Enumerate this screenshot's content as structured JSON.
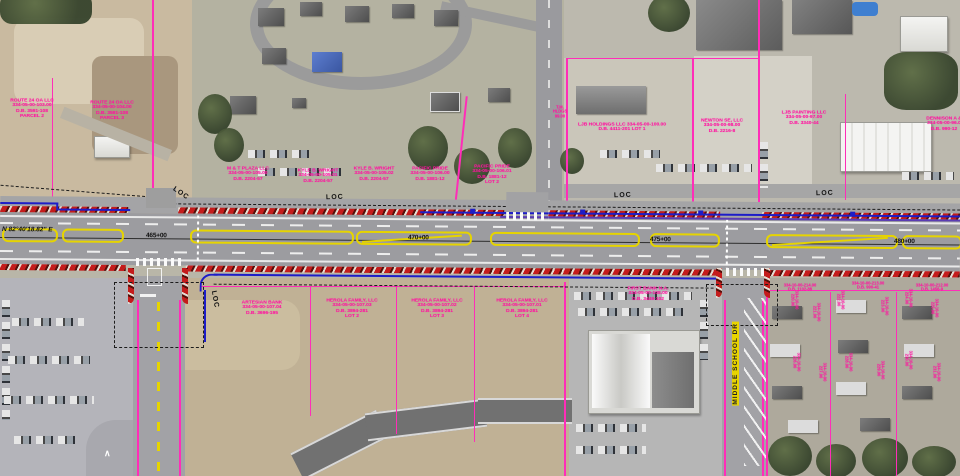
{
  "road": {
    "bearing": "N 82°40'18.82\" E",
    "stations": [
      "465+00",
      "470+00",
      "475+00",
      "480+00"
    ],
    "loc_label": "LOC",
    "street_name_vertical": "MIDDLE SCHOOL DR"
  },
  "annotations": [
    {
      "x": 32,
      "y": 98,
      "rot": 0,
      "lines": [
        "ROUTE 24 OA LLC",
        "334-05-00-103.00",
        "D.B. 3591-108",
        "PARCEL 2"
      ]
    },
    {
      "x": 112,
      "y": 100,
      "rot": 0,
      "lines": [
        "ROUTE 24 OA LLC",
        "334-05-00-104.00",
        "D.B. 3591-108",
        "PARCEL 3"
      ]
    },
    {
      "x": 248,
      "y": 166,
      "rot": 0,
      "lines": [
        "M & T PLAZA LLC",
        "334-05-00-105.00",
        "D.B. 2204-57"
      ]
    },
    {
      "x": 318,
      "y": 168,
      "rot": 0,
      "lines": [
        "KYLE B. WRIGHT",
        "334-05-00-105.01",
        "D.B. 2204-57"
      ]
    },
    {
      "x": 374,
      "y": 166,
      "rot": 0,
      "lines": [
        "KYLE B. WRIGHT",
        "334-05-00-105.02",
        "D.B. 2204-57"
      ]
    },
    {
      "x": 430,
      "y": 166,
      "rot": 0,
      "lines": [
        "PACIFIC PRIDE",
        "334-05-00-106.00",
        "D.B. 1881-12"
      ]
    },
    {
      "x": 492,
      "y": 164,
      "rot": 0,
      "lines": [
        "PACIFIC PRIDE",
        "334-05-00-106.01",
        "D.B. 1881-12",
        "LOT 2"
      ]
    },
    {
      "x": 560,
      "y": 106,
      "rot": 0,
      "lines": [
        "T.M.",
        "HLDGS",
        "99.00"
      ],
      "small": true
    },
    {
      "x": 622,
      "y": 122,
      "rot": 0,
      "lines": [
        "LJB HOLDINGS LLC  334-05-00-100.00",
        "D.B. 4411-201  LOT 1"
      ]
    },
    {
      "x": 722,
      "y": 118,
      "rot": 0,
      "lines": [
        "NEWTON SE, LLC",
        "334-05-00-98.00",
        "D.B. 2216-8"
      ]
    },
    {
      "x": 804,
      "y": 110,
      "rot": 0,
      "lines": [
        "LJB PAINTING LLC",
        "334-05-00-97.00",
        "D.B. 3340-44"
      ]
    },
    {
      "x": 944,
      "y": 116,
      "rot": 0,
      "lines": [
        "DENNISON A &",
        "334-05-00-96.0",
        "D.B. 990-12"
      ]
    },
    {
      "x": 262,
      "y": 300,
      "rot": 0,
      "lines": [
        "ARTESIAN BANK",
        "334-05-00-107.04",
        "D.B. 3696-195"
      ]
    },
    {
      "x": 352,
      "y": 298,
      "rot": 0,
      "lines": [
        "HEROLA FAMILY, LLC",
        "334-05-00-107.03",
        "D.B. 3894-281",
        "LOT 2"
      ]
    },
    {
      "x": 437,
      "y": 298,
      "rot": 0,
      "lines": [
        "HEROLA FAMILY, LLC",
        "334-05-00-107.02",
        "D.B. 3894-281",
        "LOT 3"
      ]
    },
    {
      "x": 522,
      "y": 298,
      "rot": 0,
      "lines": [
        "HEROLA FAMILY, LLC",
        "334-05-00-107.01",
        "D.B. 3894-281",
        "LOT 4"
      ]
    },
    {
      "x": 648,
      "y": 286,
      "rot": 0,
      "lines": [
        "FIRST BANK N.A.",
        "334-05-00-108.00",
        "D.B. 3449-102"
      ]
    },
    {
      "x": 800,
      "y": 284,
      "rot": 0,
      "lines": [
        "334-10-00-214.00",
        "D.B. 1102-88"
      ],
      "small": true
    },
    {
      "x": 868,
      "y": 282,
      "rot": 0,
      "lines": [
        "334-10-00-213.00",
        "D.B. 990-41"
      ],
      "small": true
    },
    {
      "x": 932,
      "y": 284,
      "rot": 0,
      "lines": [
        "334-10-00-212.00",
        "D.B. 1456-9"
      ],
      "small": true
    },
    {
      "x": 798,
      "y": 300,
      "rot": 90,
      "lines": [
        "334-10-00",
        "220.00"
      ],
      "small": true
    },
    {
      "x": 820,
      "y": 312,
      "rot": 90,
      "lines": [
        "334-10-00",
        "221.00"
      ],
      "small": true
    },
    {
      "x": 844,
      "y": 300,
      "rot": 90,
      "lines": [
        "334-10-00",
        "222.00"
      ],
      "small": true
    },
    {
      "x": 888,
      "y": 306,
      "rot": 90,
      "lines": [
        "334-10-00",
        "223.00"
      ],
      "small": true
    },
    {
      "x": 912,
      "y": 298,
      "rot": 90,
      "lines": [
        "334-10-00",
        "224.00"
      ],
      "small": true
    },
    {
      "x": 938,
      "y": 308,
      "rot": 90,
      "lines": [
        "334-10-00",
        "225.00"
      ],
      "small": true
    },
    {
      "x": 800,
      "y": 362,
      "rot": 90,
      "lines": [
        "334-10-00",
        "226.00"
      ],
      "small": true
    },
    {
      "x": 826,
      "y": 372,
      "rot": 90,
      "lines": [
        "334-10-00",
        "227.00"
      ],
      "small": true
    },
    {
      "x": 852,
      "y": 362,
      "rot": 90,
      "lines": [
        "334-10-00",
        "228.00"
      ],
      "small": true
    },
    {
      "x": 884,
      "y": 370,
      "rot": 90,
      "lines": [
        "334-10-00",
        "229.00"
      ],
      "small": true
    },
    {
      "x": 912,
      "y": 360,
      "rot": 90,
      "lines": [
        "334-10-00",
        "230.00"
      ],
      "small": true
    },
    {
      "x": 940,
      "y": 372,
      "rot": 90,
      "lines": [
        "334-10-00",
        "231.00"
      ],
      "small": true
    }
  ]
}
